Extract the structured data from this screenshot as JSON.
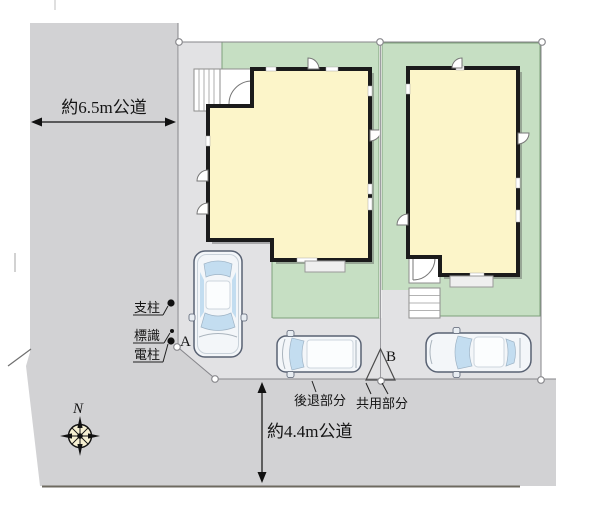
{
  "labels": {
    "road_left": "約6.5m公道",
    "road_bottom": "約4.4m公道",
    "support_pole": "支柱",
    "sign": "標識",
    "utility_pole": "電柱",
    "point_a": "A",
    "point_b": "B",
    "setback_area": "後退部分",
    "shared_area": "共用部分",
    "compass_north": "N"
  },
  "colors": {
    "road": "#d2d2d4",
    "site": "#e2e2e4",
    "plot_green": "#c6dfc3",
    "plot_green_border": "#7fa07b",
    "building_fill": "#fcf5c9",
    "building_wall": "#1b1b1b",
    "glass": "#c3ddf0",
    "car_body": "#f3f6f9",
    "compass_face": "#f6f0d2",
    "ink": "#141414"
  }
}
